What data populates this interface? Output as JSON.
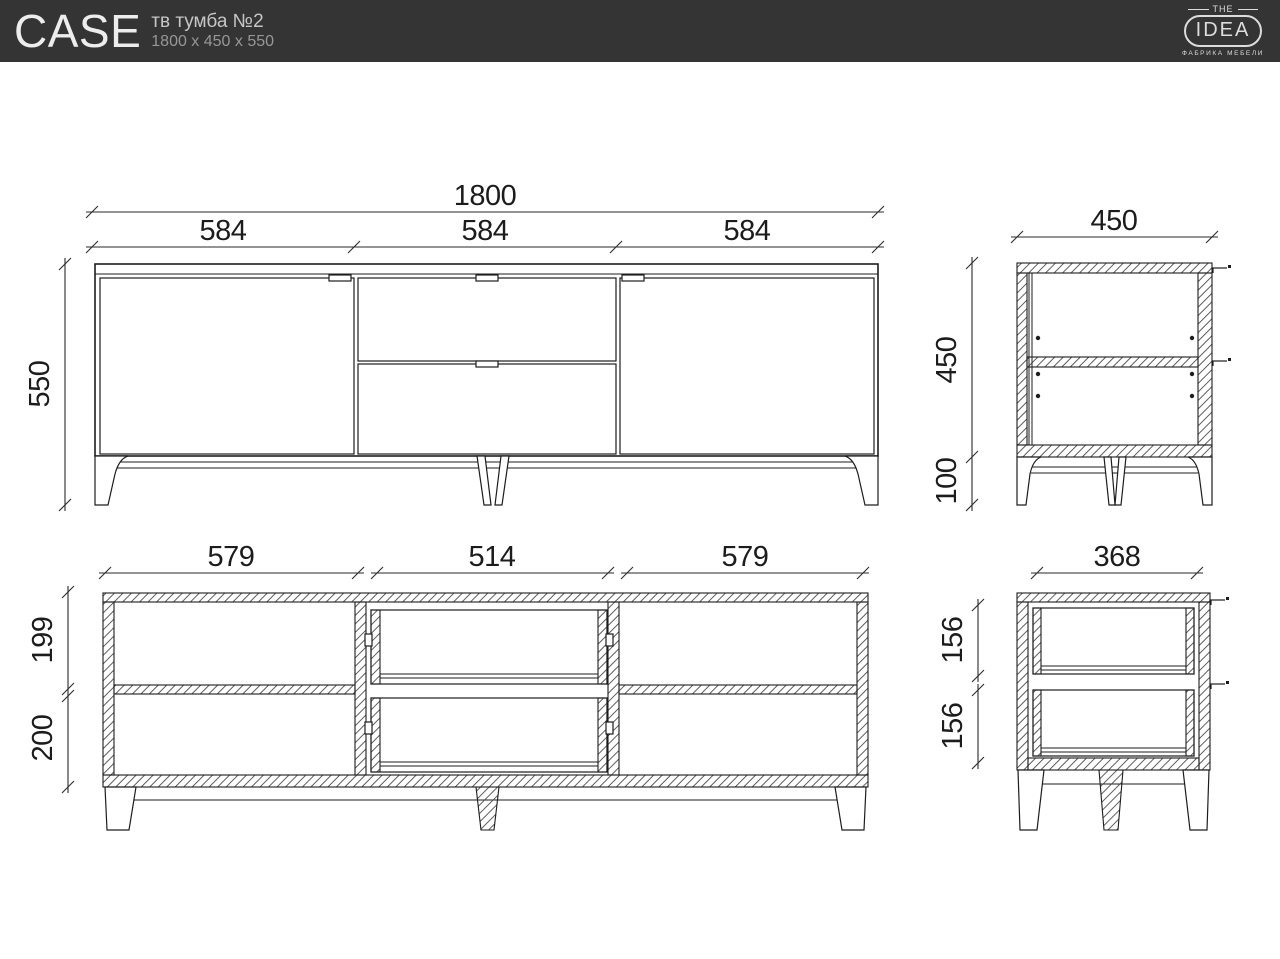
{
  "header": {
    "brand": "CASE",
    "product_name": "тв тумба №2",
    "product_size": "1800 x 450 x 550",
    "logo": {
      "top": "THE",
      "main": "IDEA",
      "sub": "ФАБРИКА МЕБЕЛИ"
    }
  },
  "drawing": {
    "front_view": {
      "total_width": "1800",
      "section_widths": [
        "584",
        "584",
        "584"
      ],
      "total_height": "550"
    },
    "side_view": {
      "depth": "450",
      "body_height": "450",
      "leg_height": "100"
    },
    "front_section": {
      "inner_widths": [
        "579",
        "514",
        "579"
      ],
      "upper_inner_height": "199",
      "lower_inner_height": "200"
    },
    "side_section": {
      "inner_depth": "368",
      "drawer_heights": [
        "156",
        "156"
      ]
    }
  },
  "colors": {
    "header_bg": "#343434",
    "line": "#1d1d1d",
    "background": "#ffffff"
  }
}
